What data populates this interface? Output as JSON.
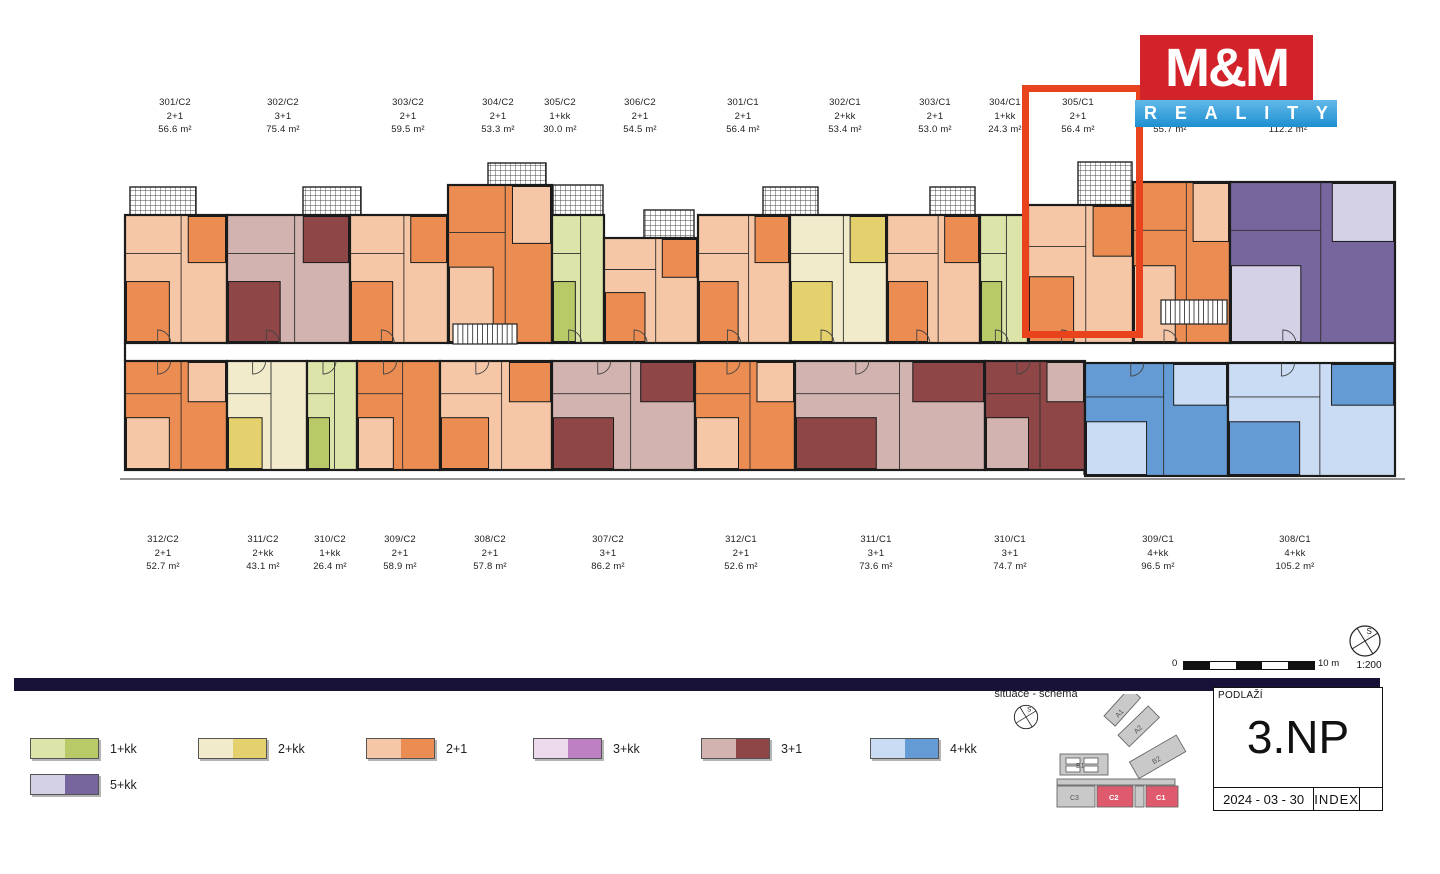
{
  "logo": {
    "name": "M&M",
    "reality": "REALITY",
    "red": "#d2232a"
  },
  "highlight": {
    "unit": "305/C1",
    "color": "#e8431d"
  },
  "palette": {
    "1+kk": {
      "light": "#dde4a9",
      "dark": "#b7ca67"
    },
    "2+kk": {
      "light": "#f1ebcb",
      "dark": "#e4d16d"
    },
    "2+1": {
      "light": "#f5c7a7",
      "dark": "#eb8c52"
    },
    "3+kk": {
      "light": "#ecdaec",
      "dark": "#bd80c2"
    },
    "3+1": {
      "light": "#d2b3af",
      "dark": "#8e4646"
    },
    "4+kk": {
      "light": "#cadcf3",
      "dark": "#649bd4"
    },
    "5+kk": {
      "light": "#d4d0e6",
      "dark": "#77659e"
    }
  },
  "units": {
    "top": [
      {
        "id": "301/C2",
        "layout": "2+1",
        "area": "56.6 m²",
        "shade": "light"
      },
      {
        "id": "302/C2",
        "layout": "3+1",
        "area": "75.4 m²",
        "shade": "light"
      },
      {
        "id": "303/C2",
        "layout": "2+1",
        "area": "59.5 m²",
        "shade": "light"
      },
      {
        "id": "304/C2",
        "layout": "2+1",
        "area": "53.3 m²",
        "shade": "dark"
      },
      {
        "id": "305/C2",
        "layout": "1+kk",
        "area": "30.0 m²",
        "shade": "light"
      },
      {
        "id": "306/C2",
        "layout": "2+1",
        "area": "54.5 m²",
        "shade": "light"
      },
      {
        "id": "301/C1",
        "layout": "2+1",
        "area": "56.4 m²",
        "shade": "light"
      },
      {
        "id": "302/C1",
        "layout": "2+kk",
        "area": "53.4 m²",
        "shade": "light"
      },
      {
        "id": "303/C1",
        "layout": "2+1",
        "area": "53.0 m²",
        "shade": "light"
      },
      {
        "id": "304/C1",
        "layout": "1+kk",
        "area": "24.3 m²",
        "shade": "light"
      },
      {
        "id": "305/C1",
        "layout": "2+1",
        "area": "56.4 m²",
        "shade": "light",
        "highlighted": true
      },
      {
        "id": "306/C1",
        "layout": "2+1",
        "area": "55.7 m²",
        "shade": "dark"
      },
      {
        "id": "307/C1",
        "layout": "5+kk",
        "area": "112.2 m²",
        "shade": "dark"
      }
    ],
    "bottom": [
      {
        "id": "312/C2",
        "layout": "2+1",
        "area": "52.7 m²",
        "shade": "dark"
      },
      {
        "id": "311/C2",
        "layout": "2+kk",
        "area": "43.1 m²",
        "shade": "light"
      },
      {
        "id": "310/C2",
        "layout": "1+kk",
        "area": "26.4 m²",
        "shade": "light"
      },
      {
        "id": "309/C2",
        "layout": "2+1",
        "area": "58.9 m²",
        "shade": "dark"
      },
      {
        "id": "308/C2",
        "layout": "2+1",
        "area": "57.8 m²",
        "shade": "light"
      },
      {
        "id": "307/C2",
        "layout": "3+1",
        "area": "86.2 m²",
        "shade": "light"
      },
      {
        "id": "312/C1",
        "layout": "2+1",
        "area": "52.6 m²",
        "shade": "dark"
      },
      {
        "id": "311/C1",
        "layout": "3+1",
        "area": "73.6 m²",
        "shade": "light"
      },
      {
        "id": "310/C1",
        "layout": "3+1",
        "area": "74.7 m²",
        "shade": "dark"
      },
      {
        "id": "309/C1",
        "layout": "4+kk",
        "area": "96.5 m²",
        "shade": "dark"
      },
      {
        "id": "308/C1",
        "layout": "4+kk",
        "area": "105.2 m²",
        "shade": "light"
      }
    ]
  },
  "legend": {
    "items": [
      "1+kk",
      "2+kk",
      "2+1",
      "3+kk",
      "3+1",
      "4+kk",
      "5+kk"
    ]
  },
  "scalebar": {
    "zero": "0",
    "max": "10 m",
    "ratio": "1:200"
  },
  "north": {
    "letter": "S"
  },
  "situace": {
    "title": "situace - schéma",
    "buildings": [
      "A1",
      "A2",
      "B1",
      "B2",
      "C3",
      "C2",
      "C1"
    ],
    "highlighted": [
      "C2",
      "C1"
    ],
    "red": "#e05a6e",
    "gray": "#c9c9c9"
  },
  "titleblock": {
    "header": "PODLAŽÍ",
    "floor": "3.NP",
    "date": "2024 - 03 - 30",
    "index": "INDEX"
  }
}
